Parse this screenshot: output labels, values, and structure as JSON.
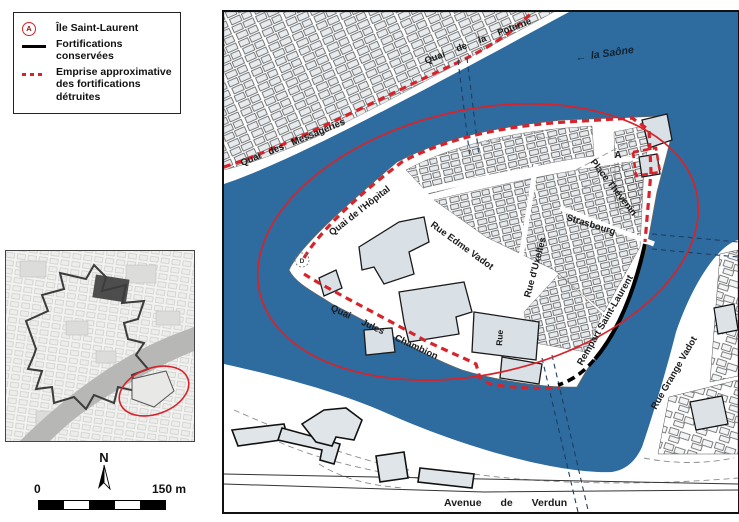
{
  "legend": {
    "items": [
      {
        "symbol": "circle-a-icon",
        "letter": "A",
        "label": "Île Saint-Laurent"
      },
      {
        "symbol": "solid-line-icon",
        "label": "Fortifications conservées"
      },
      {
        "symbol": "dotted-line-icon",
        "label": "Emprise approximative des fortifications détruites"
      }
    ]
  },
  "north_label": "N",
  "scale_bar": {
    "zero": "0",
    "max": "150 m"
  },
  "map": {
    "water_label": "la Saône",
    "water_arrow": "←",
    "island_marker": "A",
    "west_marker": "D",
    "streets": {
      "quai_poterne": "Quai de la Poterne",
      "quai_messageries": "Quai des Messageries",
      "quai_hopital": "Quai de l'Hôpital",
      "place_thevenin": "Place Thévenin",
      "rue_strasbourg": "Strasbourg",
      "rue_uxelles": "Rue d'Uxelles",
      "rue_edme_vadot": "Rue Edme Vadot",
      "rempart_saint_laurent": "Rempart Saint-Laurent",
      "quai_chambion": "Quai Jules Chambion",
      "rue_grange_vadot": "Rue Grange Vadot",
      "avenue_verdun": "Avenue de Verdun",
      "rue_small": "Rue"
    }
  },
  "colors": {
    "water": "#2E6B9E",
    "fort_destroyed": "#D8232A",
    "fort_conserved": "#000000",
    "building_fill": "#DDE3E8"
  }
}
